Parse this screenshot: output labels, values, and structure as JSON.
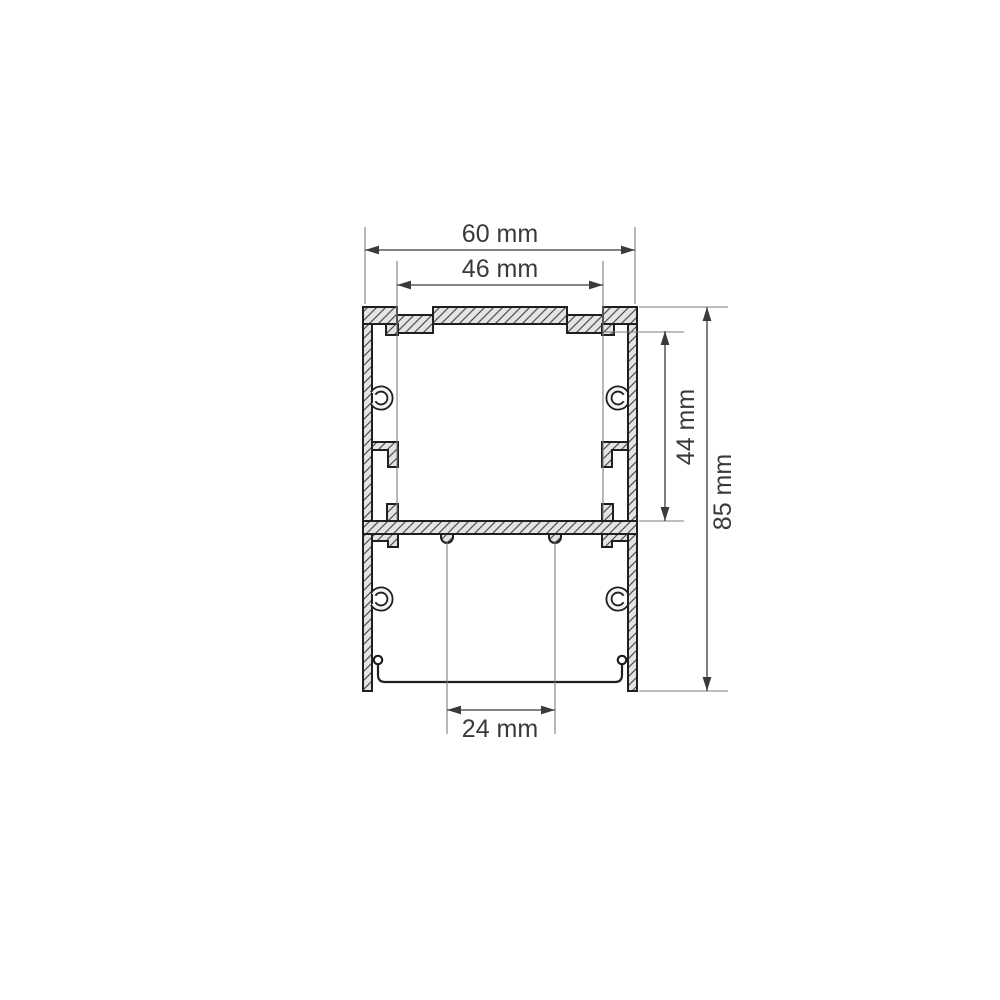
{
  "drawing": {
    "type": "technical-cross-section",
    "subject": "aluminum-led-profile",
    "background_color": "#ffffff",
    "outline_color": "#1f1f1f",
    "section_fill_color": "#e4e4e4",
    "hatch_line_color": "#4f4f4f",
    "dimension_line_color": "#3a3a3a",
    "extension_line_color": "#7d7d7d",
    "dimensions": {
      "outer_width": {
        "label": "60 mm",
        "value_mm": 60,
        "orientation": "horizontal"
      },
      "inner_width": {
        "label": "46 mm",
        "value_mm": 46,
        "orientation": "horizontal"
      },
      "inner_height": {
        "label": "44 mm",
        "value_mm": 44,
        "orientation": "vertical"
      },
      "outer_height": {
        "label": "85 mm",
        "value_mm": 85,
        "orientation": "vertical"
      },
      "bottom_opening_width": {
        "label": "24 mm",
        "value_mm": 24,
        "orientation": "horizontal"
      }
    }
  }
}
